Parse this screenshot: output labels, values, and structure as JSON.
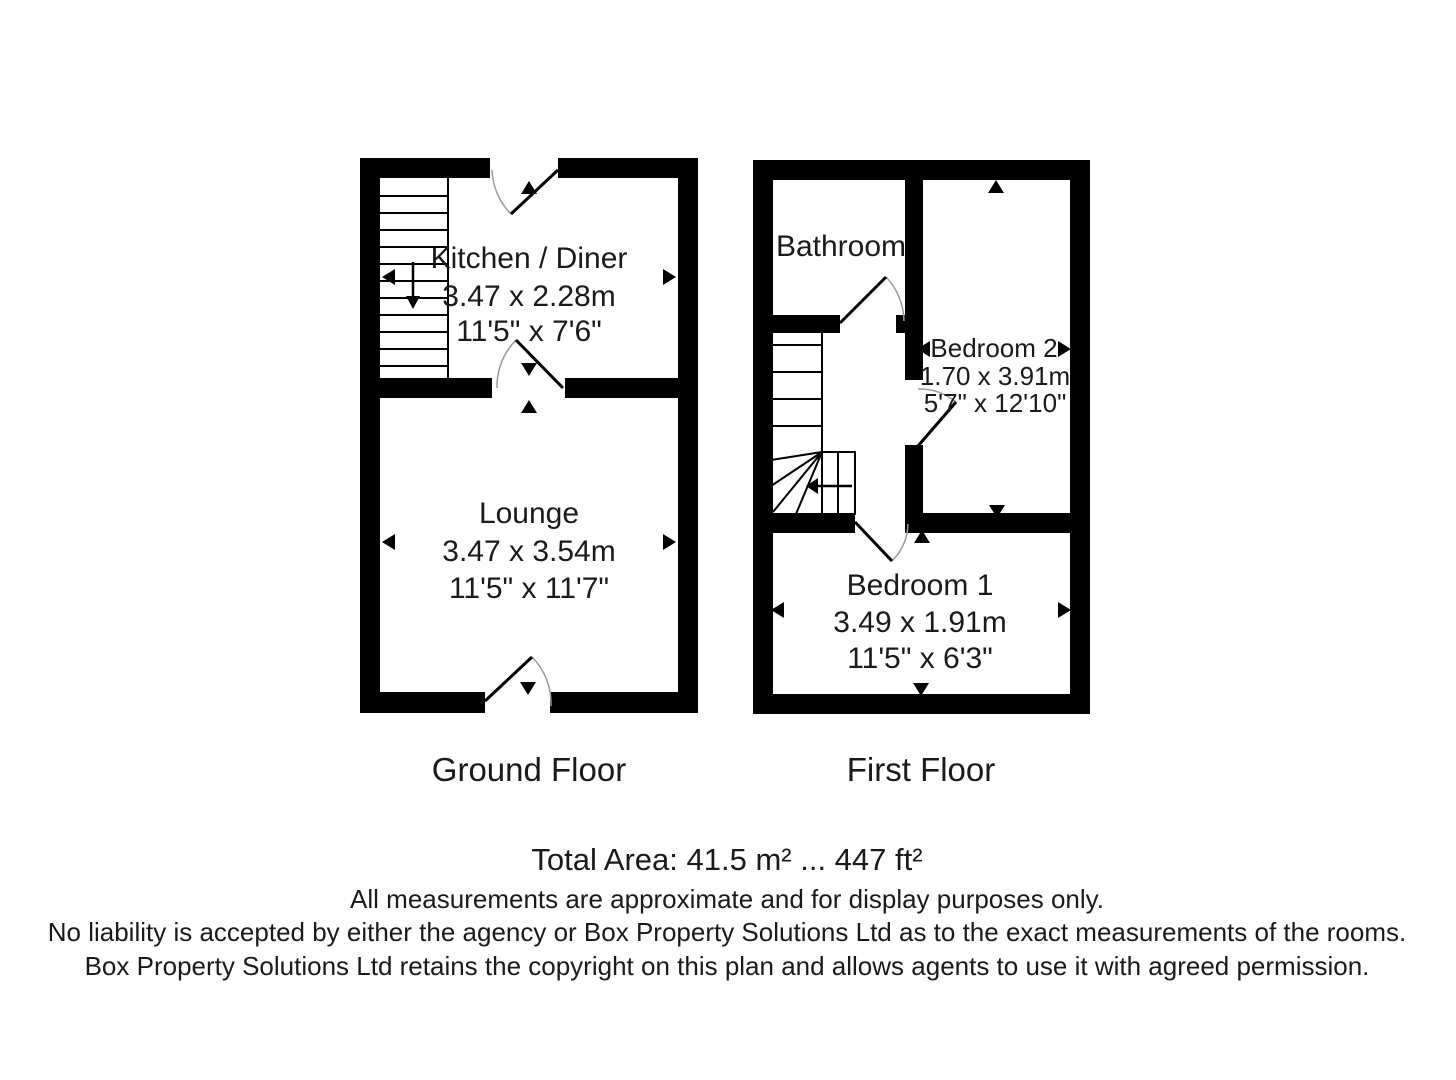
{
  "colors": {
    "background": "#ffffff",
    "walls": "#000000",
    "text": "#1a1a1a",
    "door_arc": "#9a9a9a"
  },
  "ground_floor": {
    "label": "Ground Floor",
    "rooms": [
      {
        "name": "Kitchen / Diner",
        "metric": "3.47 x 2.28m",
        "imperial": "11'5\" x 7'6\""
      },
      {
        "name": "Lounge",
        "metric": "3.47 x 3.54m",
        "imperial": "11'5\" x 11'7\""
      }
    ]
  },
  "first_floor": {
    "label": "First Floor",
    "rooms": [
      {
        "name": "Bathroom"
      },
      {
        "name": "Bedroom 2",
        "metric": "1.70 x 3.91m",
        "imperial": "5'7\" x 12'10\""
      },
      {
        "name": "Bedroom 1",
        "metric": "3.49 x 1.91m",
        "imperial": "11'5\" x 6'3\""
      }
    ]
  },
  "footer": {
    "total_area": "Total Area: 41.5 m² ... 447 ft²",
    "disclaimers": [
      "All measurements are approximate and for display purposes only.",
      "No liability is accepted by either the agency or Box Property Solutions Ltd as to the exact measurements of the rooms.",
      "Box Property Solutions Ltd retains the copyright on this plan and allows agents to use it with agreed permission."
    ]
  },
  "icons": {
    "stair_down_arrow": "↓",
    "stair_up_left_arrow": "←",
    "dimension_arrow_left": "◄",
    "dimension_arrow_right": "►",
    "dimension_arrow_up": "▲",
    "dimension_arrow_down": "▼"
  }
}
